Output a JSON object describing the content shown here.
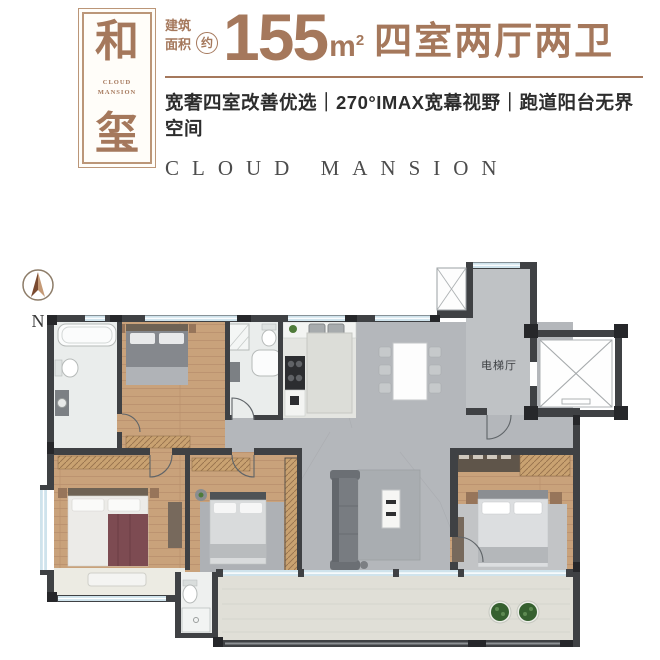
{
  "header": {
    "badge": {
      "char_top": "和",
      "char_bottom": "玺",
      "sub1": "CLOUD",
      "sub2": "MANSION"
    },
    "area": {
      "label1": "建筑",
      "label2": "面积",
      "approx": "约",
      "value": "155",
      "unit": "m",
      "unit_sup": "2",
      "rooms": "四室两厅两卫"
    },
    "tagline": "宽奢四室改善优选｜270°IMAX宽幕视野｜跑道阳台无界空间",
    "brand": "CLOUD MANSION"
  },
  "floorplan": {
    "compass": "N",
    "elevator_label": "电梯厅"
  },
  "colors": {
    "accent": "#a5785c",
    "badge_border": "#bb9678",
    "tagline": "#2d2d2d",
    "brand": "#4c4c4c",
    "wall": "#3f4144",
    "column": "#26272a",
    "wood": "#c9a27b",
    "tile": "#b4b7bb",
    "hall_tile": "#bfc2c5",
    "bath": "#eaedec",
    "kitchen_floor": "#e4e5e1",
    "balcony": "#e0dfd7",
    "window": "#cfe3ec",
    "plant": "#35602f"
  }
}
